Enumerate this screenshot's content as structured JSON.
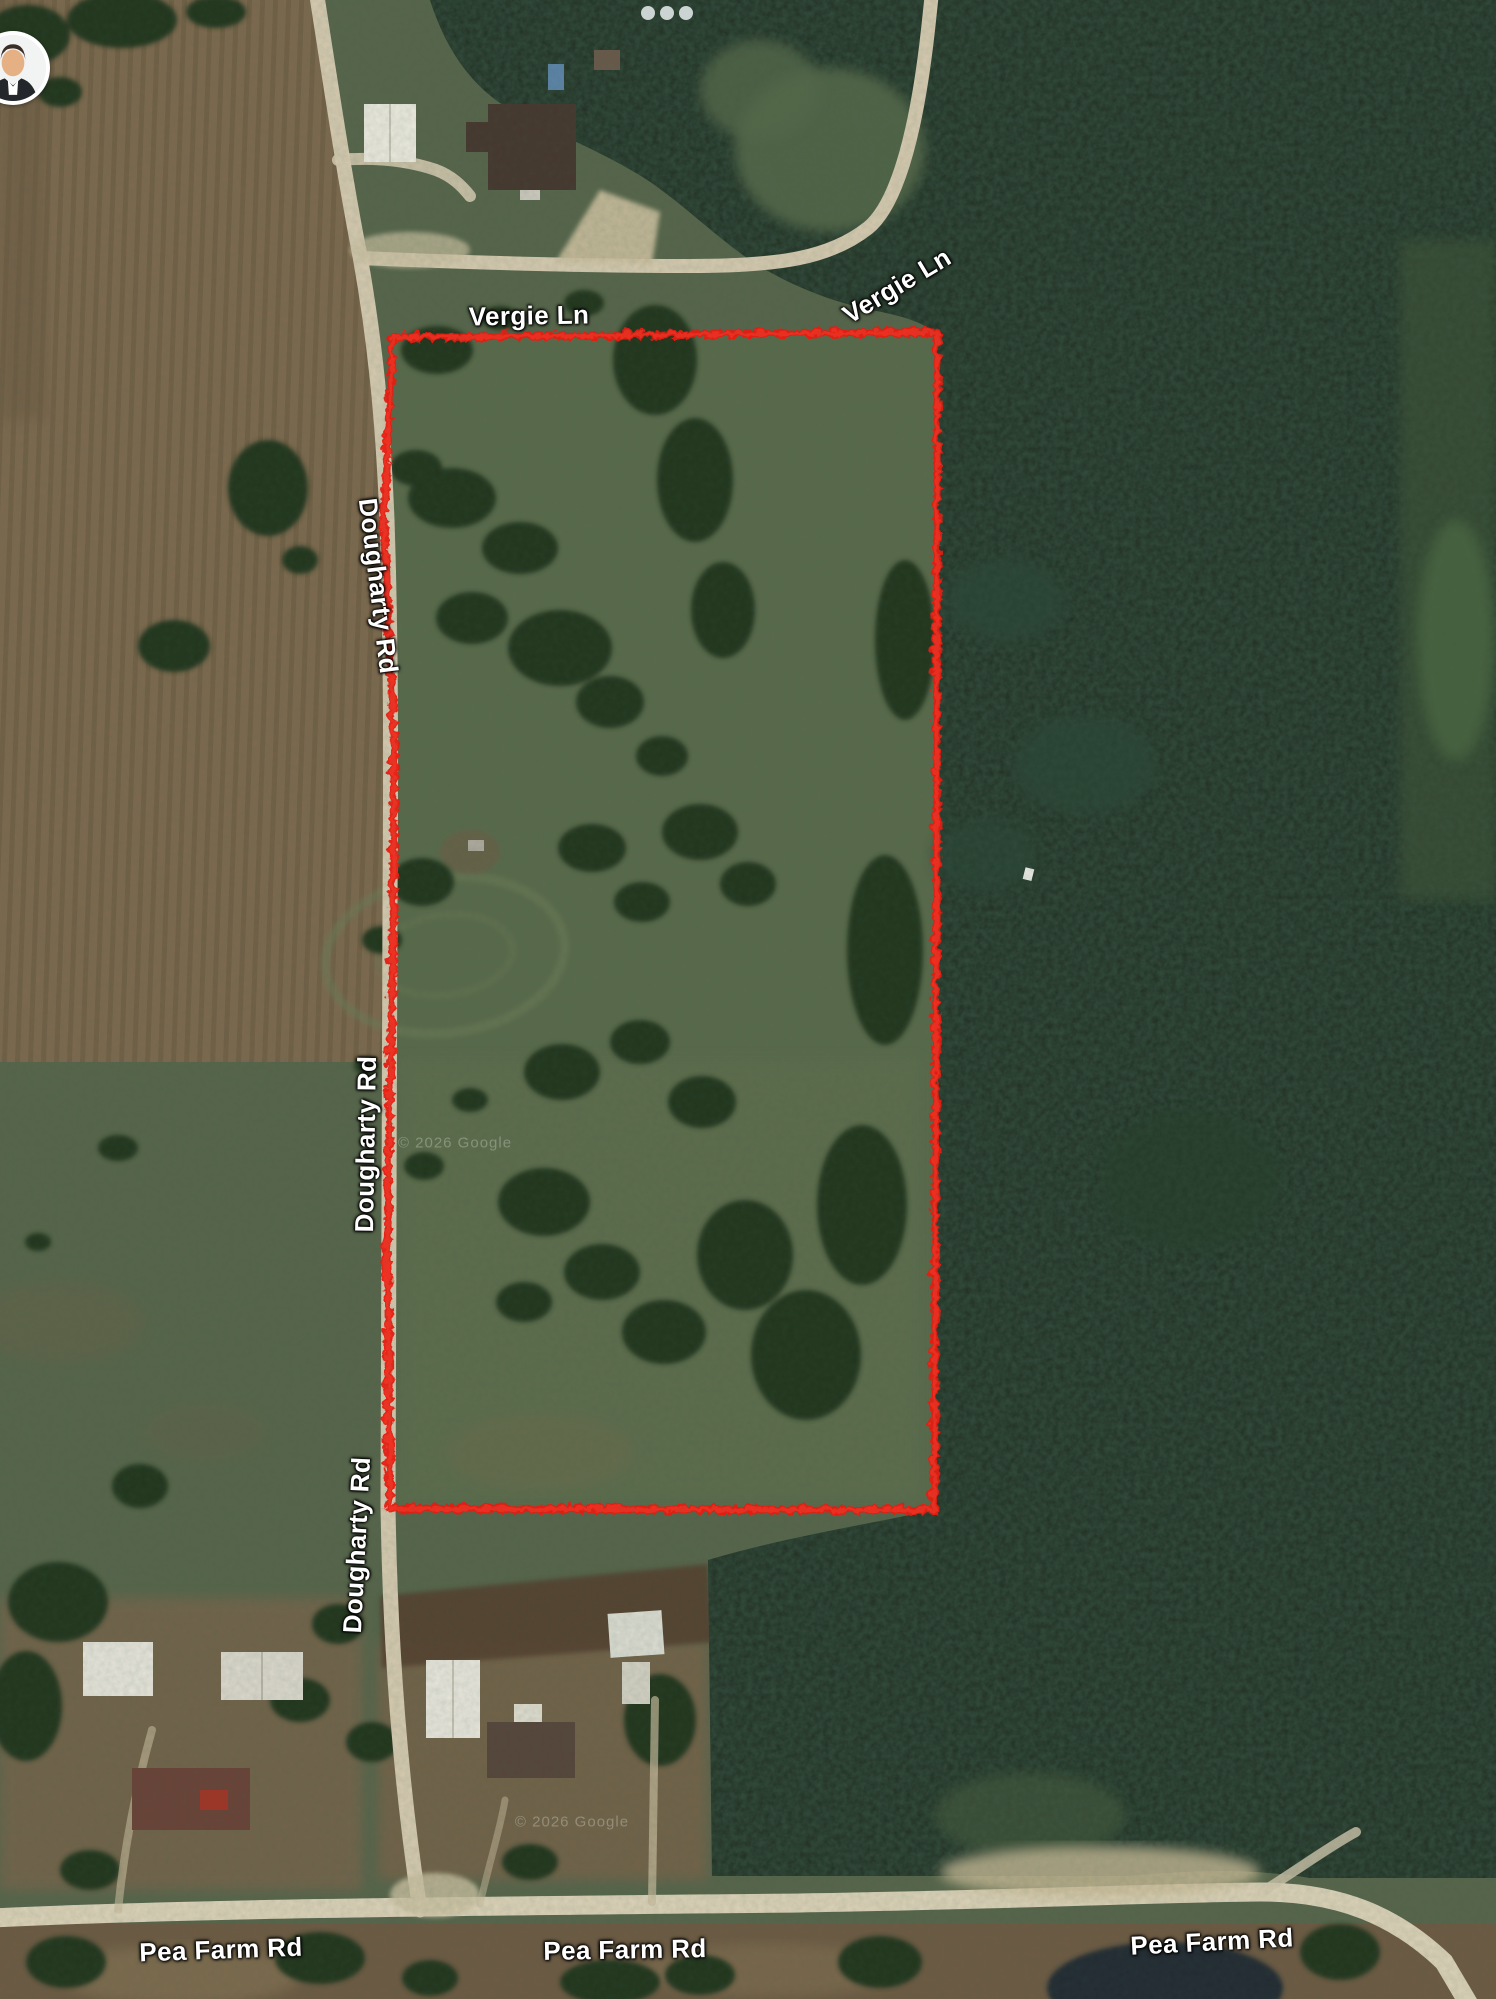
{
  "map": {
    "type": "satellite-imagery-with-property-outline",
    "boundary_color": "#f2190d",
    "road_color": "#d6cab0",
    "road_labels": [
      {
        "id": "vergie-ln-1",
        "text": "Vergie Ln"
      },
      {
        "id": "vergie-ln-2",
        "text": "Vergie Ln"
      },
      {
        "id": "dougharty-rd-1",
        "text": "Dougharty Rd"
      },
      {
        "id": "dougharty-rd-2",
        "text": "Dougharty Rd"
      },
      {
        "id": "dougharty-rd-3",
        "text": "Dougharty Rd"
      },
      {
        "id": "pea-farm-rd-1",
        "text": "Pea Farm Rd"
      },
      {
        "id": "pea-farm-rd-2",
        "text": "Pea Farm Rd"
      },
      {
        "id": "pea-farm-rd-3",
        "text": "Pea Farm Rd"
      }
    ],
    "watermarks": [
      {
        "text": "© 2026 Google"
      },
      {
        "text": "© 2026 Google"
      }
    ]
  },
  "overlay": {
    "icons": {
      "avatar": "profile-photo-bubble",
      "dots": "ellipsis-dots"
    },
    "dots_count": 3
  }
}
